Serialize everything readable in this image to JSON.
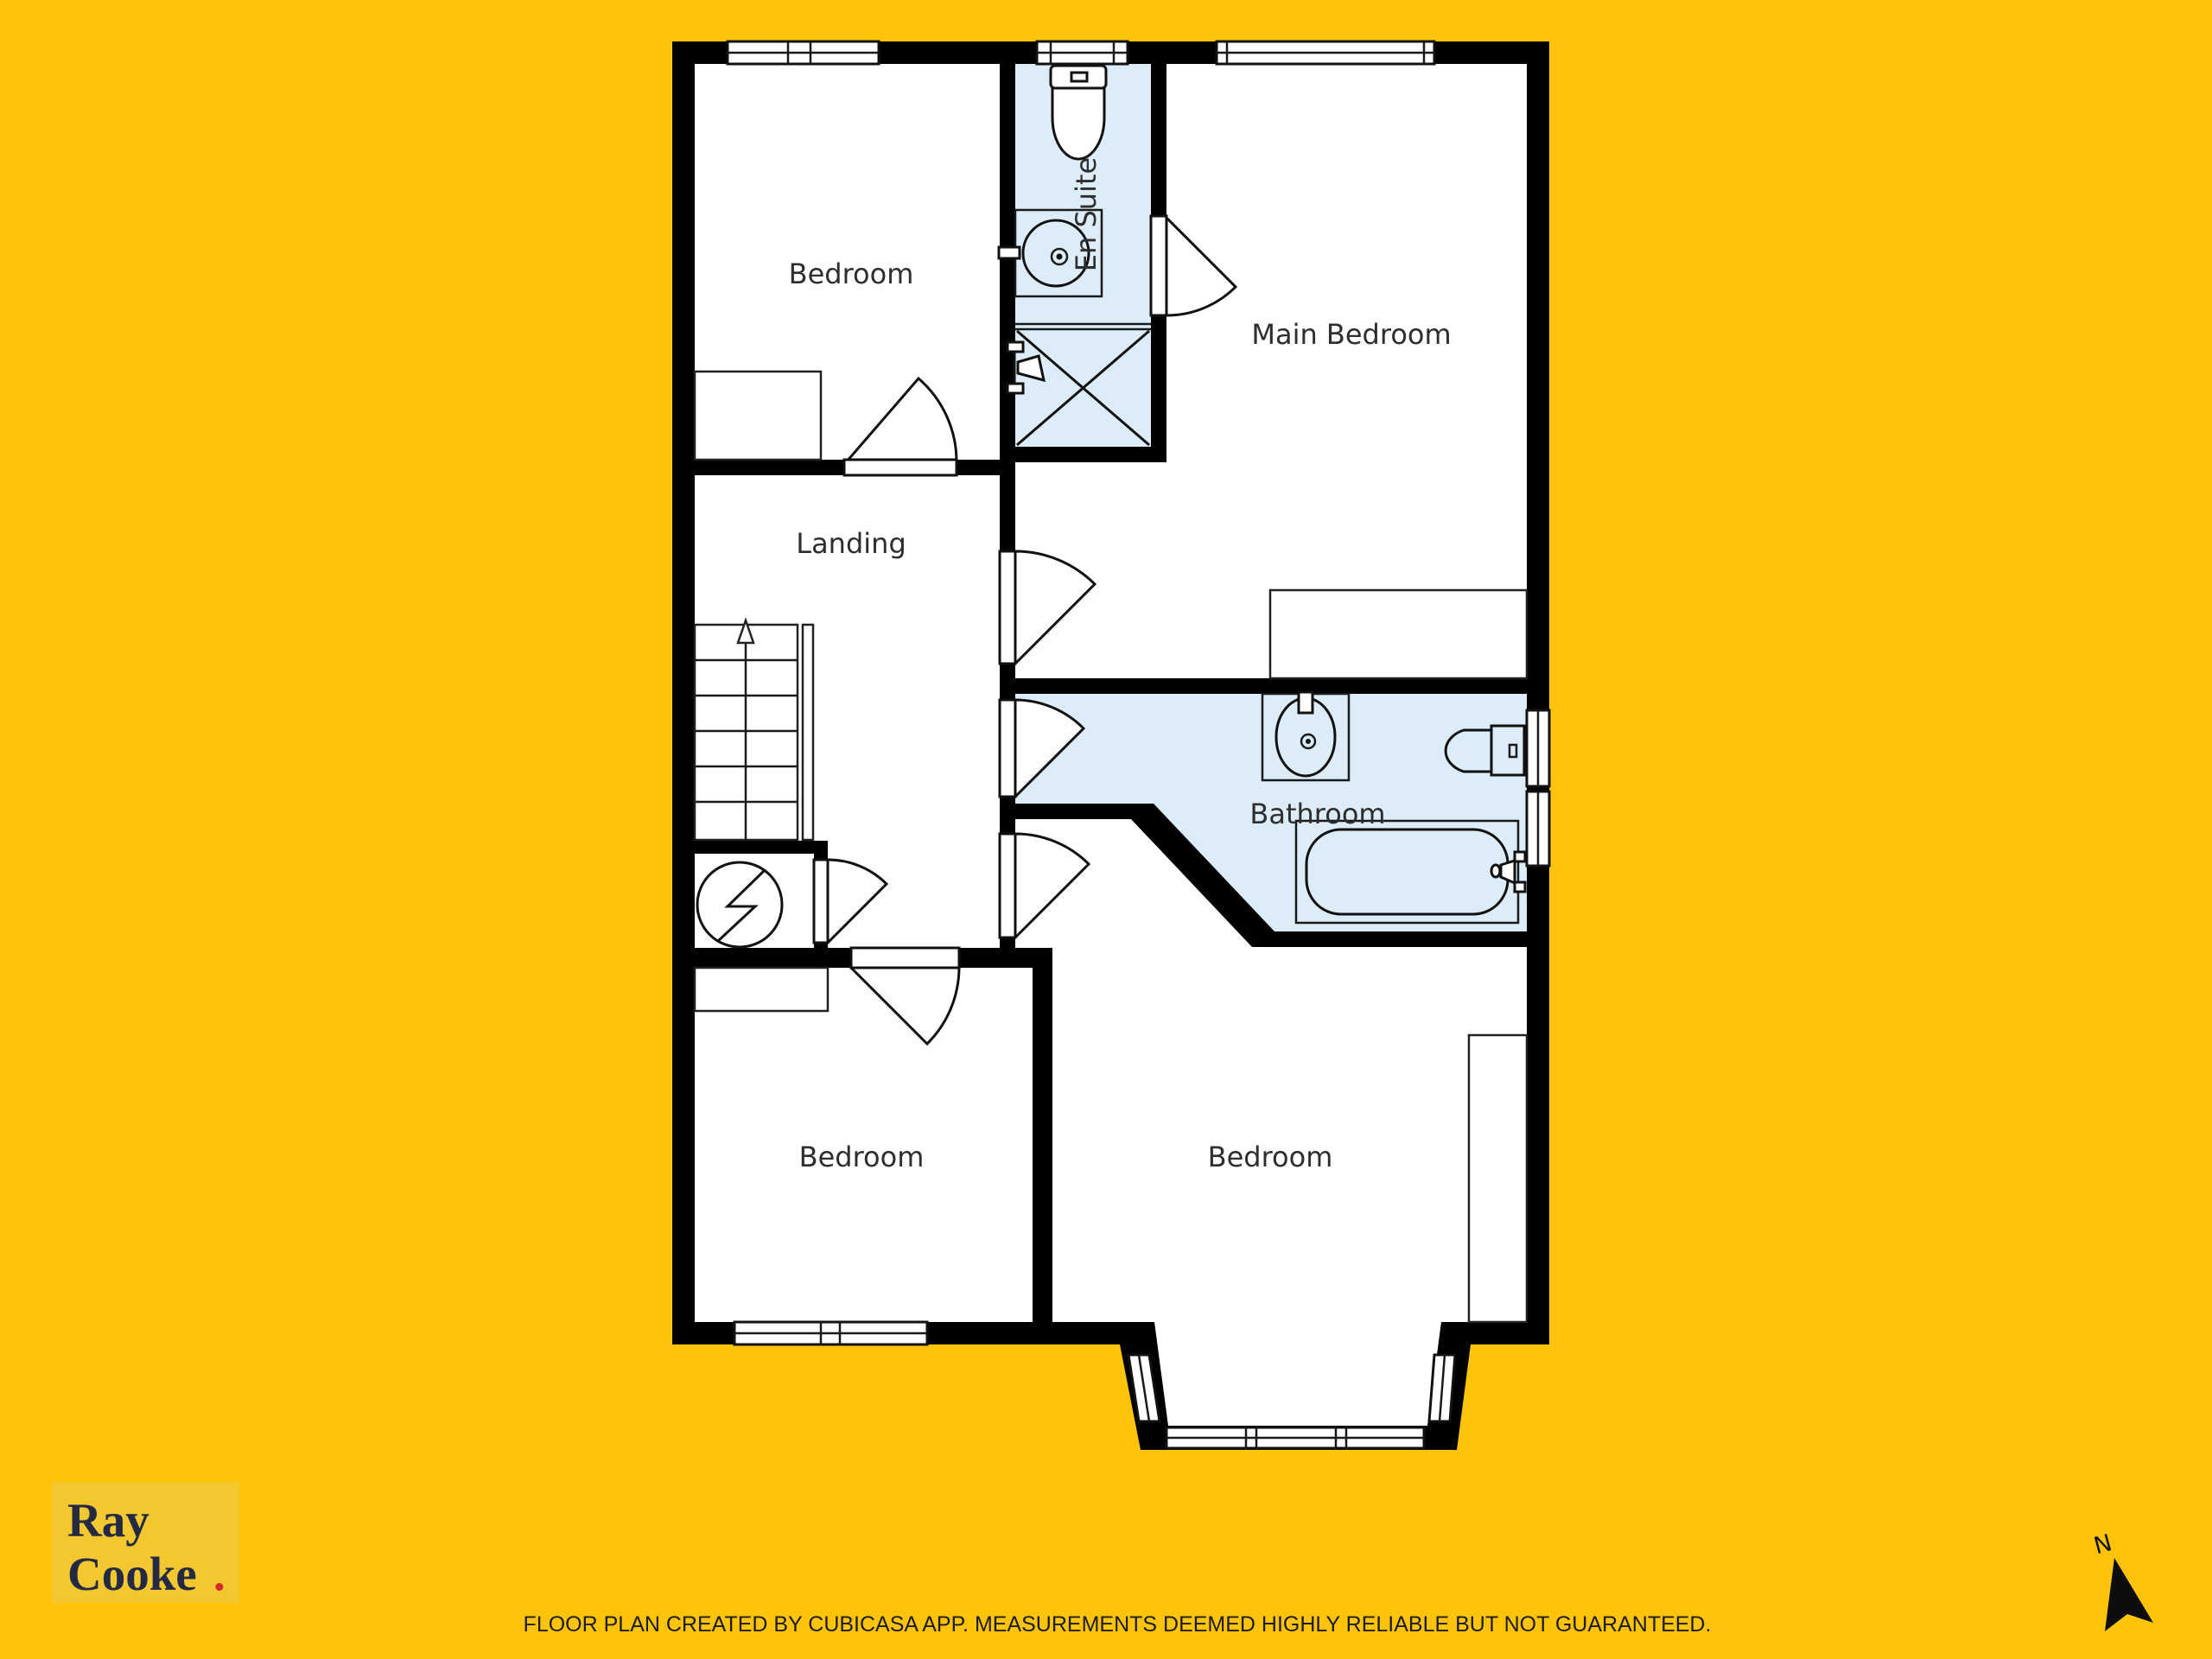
{
  "page": {
    "background_color": "#FFC40A"
  },
  "floor_plan": {
    "wet_room_color": "#DCECF8",
    "wall_color": "#000000",
    "room_fill_color": "#FFFFFF",
    "rooms": [
      {
        "id": "bedroom-top-left",
        "label": "Bedroom"
      },
      {
        "id": "en-suite",
        "label": "En Suite"
      },
      {
        "id": "main-bedroom",
        "label": "Main Bedroom"
      },
      {
        "id": "landing",
        "label": "Landing"
      },
      {
        "id": "bathroom",
        "label": "Bathroom"
      },
      {
        "id": "bedroom-bottom-left",
        "label": "Bedroom"
      },
      {
        "id": "bedroom-bottom-right",
        "label": "Bedroom"
      }
    ],
    "icons": [
      "toilet-icon",
      "sink-icon",
      "shower-icon",
      "bathtub-icon",
      "staircase-icon",
      "stairs-up-arrow-icon",
      "water-heater-icon",
      "wardrobe",
      "door-swing-icon",
      "window-icon"
    ]
  },
  "branding": {
    "logo_line1": "Ray",
    "logo_line2": "Cooke",
    "logo_dot": ".",
    "logo_box_color": "#F3C72F",
    "logo_text_color": "#242A44",
    "logo_dot_color": "#D7282F"
  },
  "compass": {
    "label": "N"
  },
  "footer": {
    "disclaimer": "FLOOR PLAN CREATED BY CUBICASA APP. MEASUREMENTS DEEMED HIGHLY RELIABLE BUT NOT GUARANTEED."
  }
}
